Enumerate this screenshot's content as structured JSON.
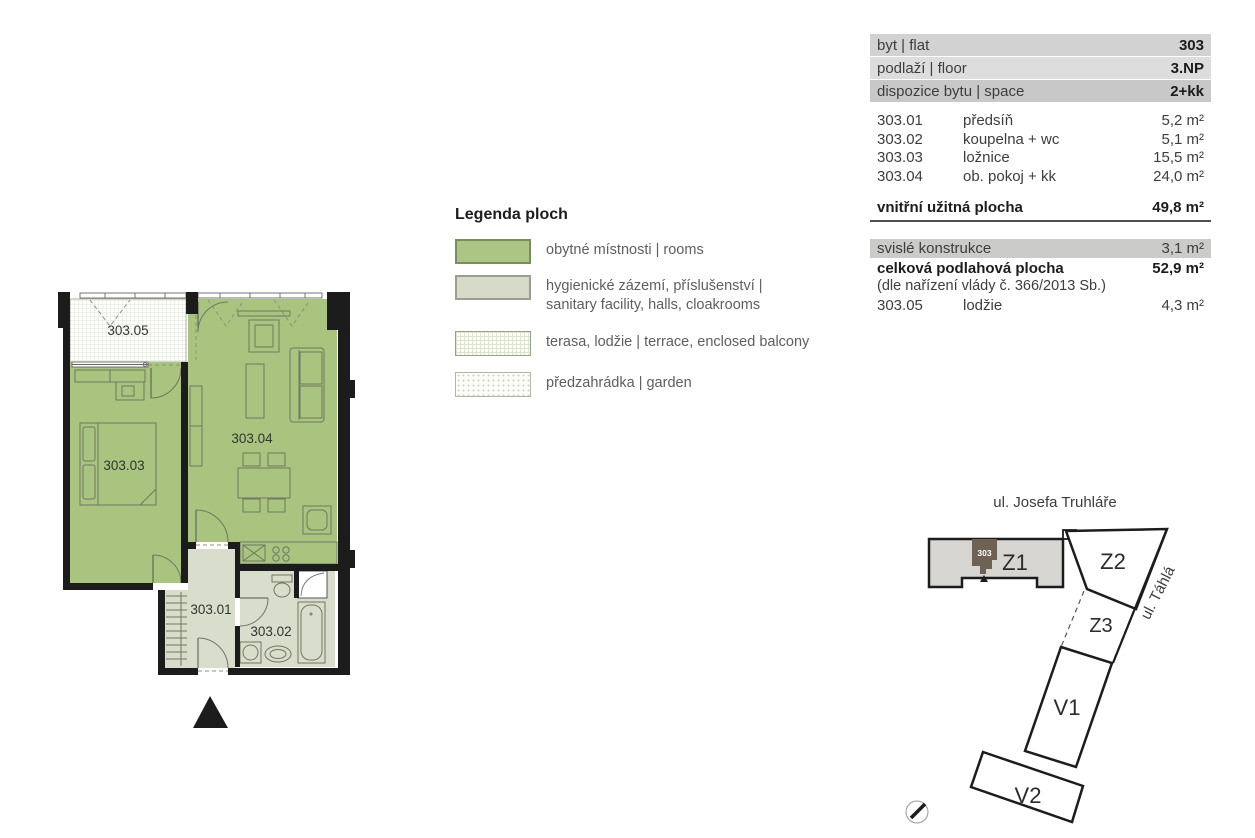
{
  "info_table": {
    "header_rows": [
      {
        "label": "byt | flat",
        "value": "303"
      },
      {
        "label": "podlaží | floor",
        "value": "3.NP"
      },
      {
        "label": "dispozice bytu | space",
        "value": "2+kk"
      }
    ],
    "rooms": [
      {
        "code": "303.01",
        "name": "předsíň",
        "area": "5,2 m²"
      },
      {
        "code": "303.02",
        "name": "koupelna + wc",
        "area": "5,1 m²"
      },
      {
        "code": "303.03",
        "name": "ložnice",
        "area": "15,5 m²"
      },
      {
        "code": "303.04",
        "name": "ob. pokoj + kk",
        "area": "24,0 m²"
      }
    ],
    "total": {
      "label": "vnitřní užitná plocha",
      "value": "49,8 m²"
    },
    "construction": {
      "label": "svislé konstrukce",
      "value": "3,1 m²"
    },
    "total_floor": {
      "label": "celková podlahová plocha",
      "value": "52,9 m²"
    },
    "note": "(dle nařízení vlády č. 366/2013 Sb.)",
    "loggia_row": {
      "code": "303.05",
      "name": "lodžie",
      "area": "4,3 m²"
    }
  },
  "legend": {
    "title": "Legenda ploch",
    "items": [
      {
        "label": "obytné místnosti | rooms"
      },
      {
        "label": "hygienické zázemí, příslušenství | sanitary facility, halls, cloakrooms"
      },
      {
        "label": "terasa, lodžie | terrace, enclosed balcony"
      },
      {
        "label": "předzahrádka | garden"
      }
    ]
  },
  "floor_plan": {
    "labels": {
      "r01": "303.01",
      "r02": "303.02",
      "r03": "303.03",
      "r04": "303.04",
      "r05": "303.05"
    }
  },
  "site_plan": {
    "street_top": "ul. Josefa Truhláře",
    "street_right": "ul. Táhlá",
    "unit": "303",
    "buildings": {
      "z1": "Z1",
      "z2": "Z2",
      "z3": "Z3",
      "v1": "V1",
      "v2": "V2"
    }
  },
  "colors": {
    "room_green": "#a9c47f",
    "sanitary": "#d8ddcc",
    "wall": "#1c1c1c",
    "unit_dark": "#6e6255",
    "building_gray": "#d7d5d2"
  }
}
